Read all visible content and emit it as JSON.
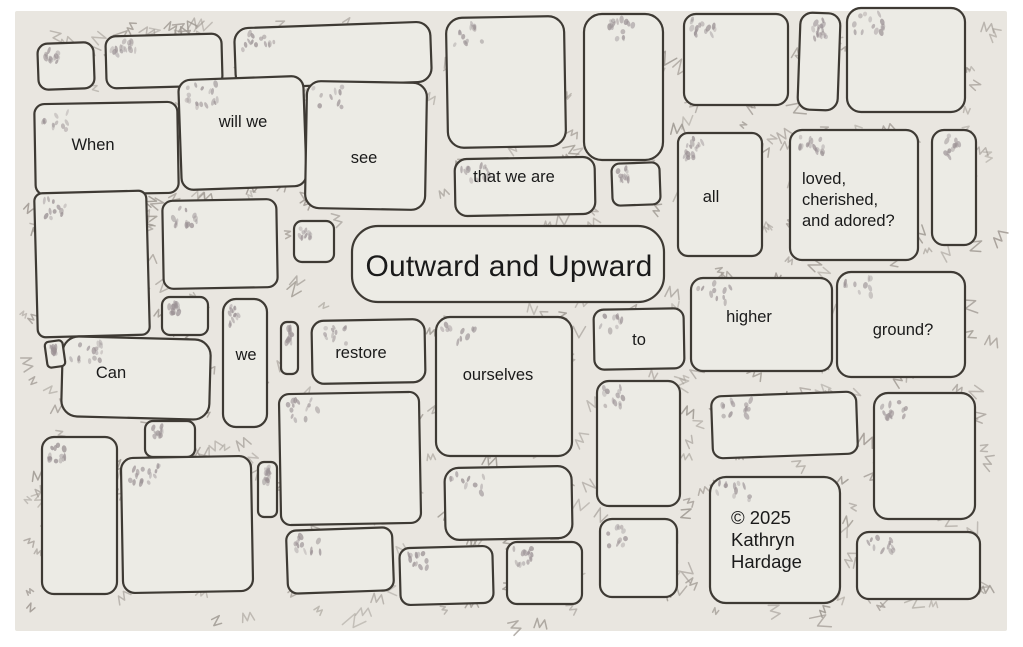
{
  "artwork": {
    "title": "Outward and Upward",
    "phrase_top": "When will we see that we are all loved, cherished, and adored?",
    "phrase_bottom": "Can we restore ourselves to higher ground?",
    "credit": "© 2025 Kathryn Hardage",
    "style_note": "hand-drawn stone wall with words on stones"
  },
  "words": {
    "when": "When",
    "will_we": "will we",
    "see": "see",
    "that_we_are": "that we are",
    "all": "all",
    "loved_1": "loved,",
    "loved_2": "cherished,",
    "loved_3": "and adored?",
    "title": "Outward and Upward",
    "can": "Can",
    "we": "we",
    "restore": "restore",
    "ourselves": "ourselves",
    "to": "to",
    "higher": "higher",
    "ground": "ground?",
    "copyright_1": "© 2025",
    "copyright_2": "Kathryn",
    "copyright_3": "Hardage"
  },
  "colors": {
    "border": "#ffffff",
    "paper": "#e9e6e0",
    "stone": "#ecebe5",
    "ink": "#3e3a34",
    "pencil": "#a09a93",
    "shade": "#9c9396",
    "text": "#1a1a1a"
  }
}
